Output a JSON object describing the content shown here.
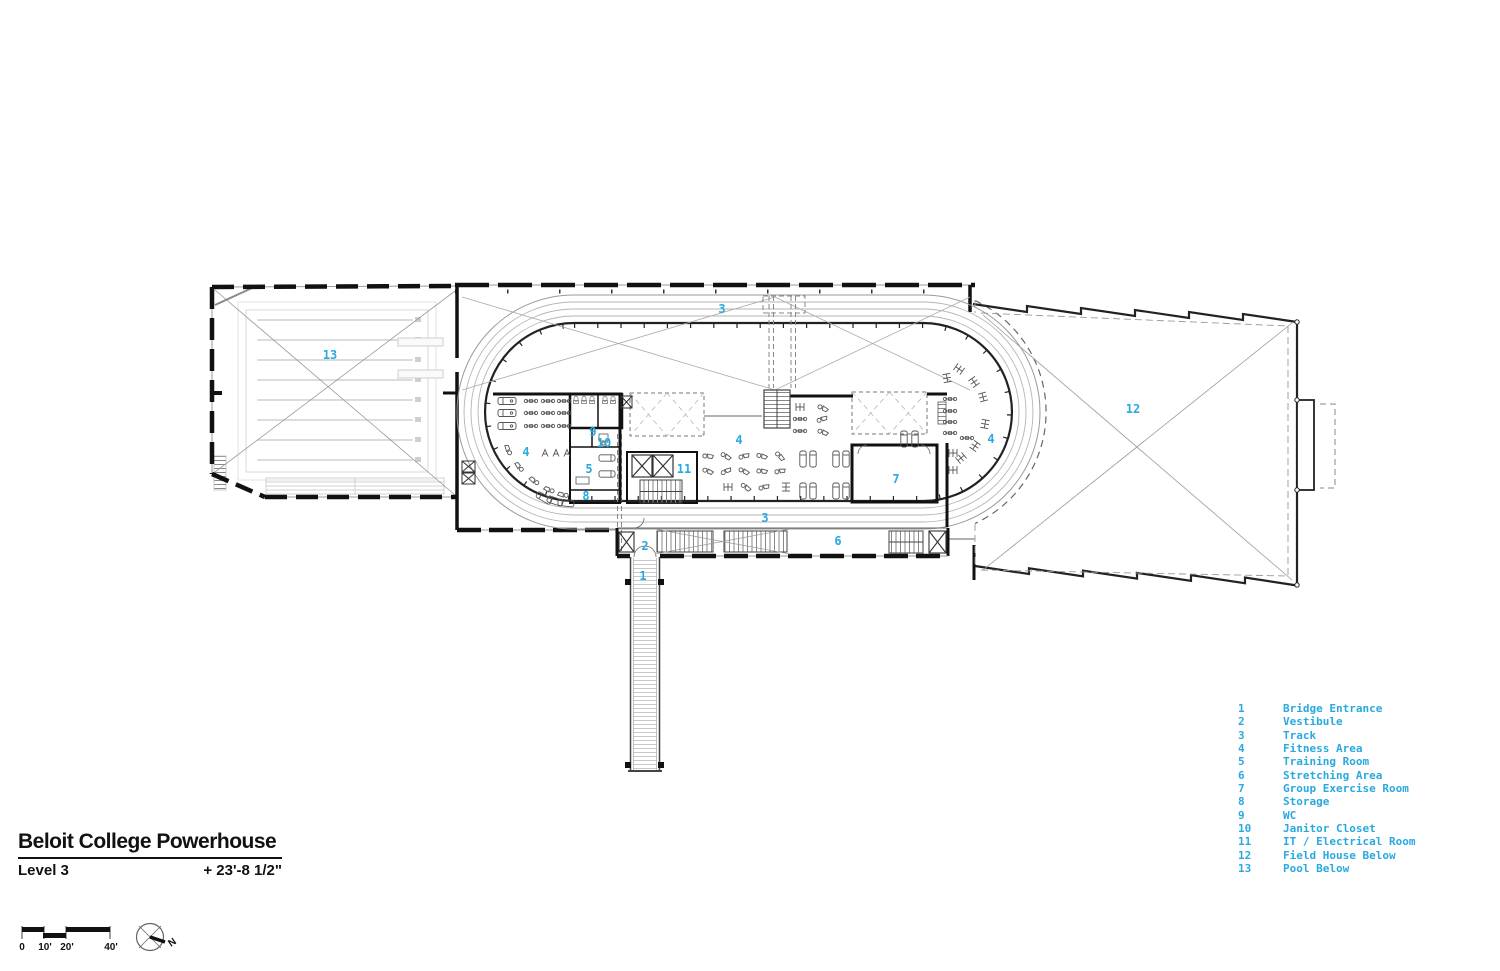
{
  "title_block": {
    "project": "Beloit College Powerhouse",
    "level": "Level 3",
    "elevation": "+ 23'-8 1/2\""
  },
  "scale_bar": {
    "labels": [
      "0",
      "10'",
      "20'",
      "40'"
    ]
  },
  "north_arrow": {
    "label": "N"
  },
  "legend": {
    "items": [
      {
        "num": "1",
        "label": "Bridge Entrance"
      },
      {
        "num": "2",
        "label": "Vestibule"
      },
      {
        "num": "3",
        "label": "Track"
      },
      {
        "num": "4",
        "label": "Fitness Area"
      },
      {
        "num": "5",
        "label": "Training Room"
      },
      {
        "num": "6",
        "label": "Stretching Area"
      },
      {
        "num": "7",
        "label": "Group Exercise Room"
      },
      {
        "num": "8",
        "label": "Storage"
      },
      {
        "num": "9",
        "label": "WC"
      },
      {
        "num": "10",
        "label": "Janitor Closet"
      },
      {
        "num": "11",
        "label": "IT / Electrical Room"
      },
      {
        "num": "12",
        "label": "Field House Below"
      },
      {
        "num": "13",
        "label": "Pool Below"
      }
    ]
  },
  "plan_labels": [
    {
      "room": "bridge-entrance",
      "text": "1"
    },
    {
      "room": "vestibule",
      "text": "2"
    },
    {
      "room": "track-top",
      "text": "3"
    },
    {
      "room": "track-bottom",
      "text": "3"
    },
    {
      "room": "fitness-area-west",
      "text": "4"
    },
    {
      "room": "fitness-area-center",
      "text": "4"
    },
    {
      "room": "fitness-area-east",
      "text": "4"
    },
    {
      "room": "training-room",
      "text": "5"
    },
    {
      "room": "stretching-area",
      "text": "6"
    },
    {
      "room": "group-exercise-room",
      "text": "7"
    },
    {
      "room": "storage",
      "text": "8"
    },
    {
      "room": "wc",
      "text": "9"
    },
    {
      "room": "janitor-closet",
      "text": "10"
    },
    {
      "room": "it-electrical-room",
      "text": "11"
    },
    {
      "room": "field-house-below",
      "text": "12"
    },
    {
      "room": "pool-below",
      "text": "13"
    }
  ],
  "colors": {
    "accent": "#29A9E0",
    "wall": "#111111",
    "line_gray": "#9a9a9a",
    "faint_gray": "#d6d6d6"
  }
}
